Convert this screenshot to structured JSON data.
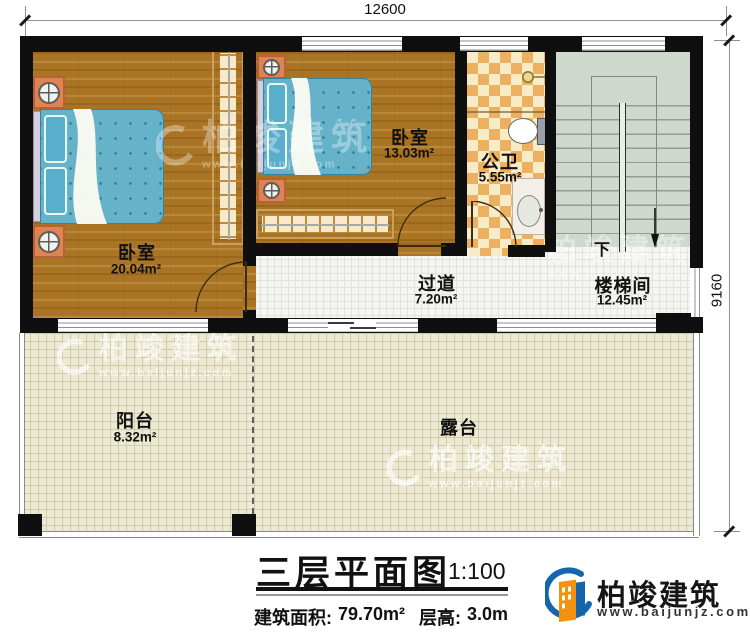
{
  "dimensions": {
    "width_mm": "12600",
    "depth_mm": "9160"
  },
  "rooms": [
    {
      "name": "卧室",
      "area": "20.04m²"
    },
    {
      "name": "卧室",
      "area": "13.03m²"
    },
    {
      "name": "公卫",
      "area": "5.55m²"
    },
    {
      "name": "过道",
      "area": "7.20m²"
    },
    {
      "name": "楼梯间",
      "area": "12.45m²"
    },
    {
      "name": "阳台",
      "area": "8.32m²"
    },
    {
      "name": "露台"
    }
  ],
  "stairs": {
    "direction_label": "下"
  },
  "title_block": {
    "title": "三层平面图",
    "scale": "1:100",
    "area_label": "建筑面积:",
    "area_value": "79.70m²",
    "height_label": "层高:",
    "height_value": "3.0m"
  },
  "branding": {
    "company_name": "柏竣建筑",
    "website": "www.baijunjz.com"
  },
  "watermark": {
    "text": "柏竣建筑",
    "website": "www.baijunjz.com"
  },
  "icons": {
    "logo": "building-swoosh-icon",
    "stairs_direction": "down-arrow-icon",
    "shower": "shower-head-icon"
  },
  "colors": {
    "wall": "#0f0f0f",
    "wood_floor": "#a97424",
    "bath_tile_orange": "#ecb160",
    "bath_tile_cream": "#f8ebc8",
    "stair_floor": "#ced8cc",
    "hall_tile": "#f5f5f2",
    "outdoor_tile": "#edead3",
    "bed_blue": "#66b2c8",
    "furniture_orange": "#df8350",
    "logo_blue": "#1565ad",
    "logo_orange": "#f39210"
  }
}
